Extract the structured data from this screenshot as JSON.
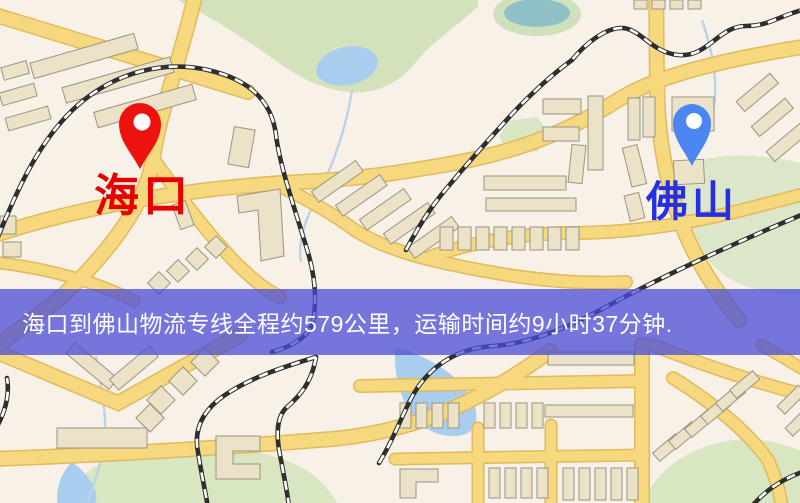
{
  "map": {
    "origin": {
      "label": "海口",
      "pin_color": "#ec130e",
      "label_color": "#e60000"
    },
    "destination": {
      "label": "佛山",
      "pin_color": "#4b86f2",
      "label_color": "#2330e6"
    }
  },
  "banner": {
    "text": "海口到佛山物流专线全程约579公里，运输时间约9小时37分钟.",
    "background": "#4a4bd8",
    "text_color": "#ffffff"
  },
  "palette": {
    "map_background": "#f7f1e7",
    "road_fill": "#f6d97f",
    "road_casing": "#e2b95c",
    "park": "#d3e2ba",
    "water": "#a9cdee",
    "pond_teal": "#8fc0c6",
    "building": "#ebe2c8",
    "building_outline": "#9a9482",
    "railway_dark": "#2e2e2e",
    "railway_dash": "#ffffff"
  }
}
